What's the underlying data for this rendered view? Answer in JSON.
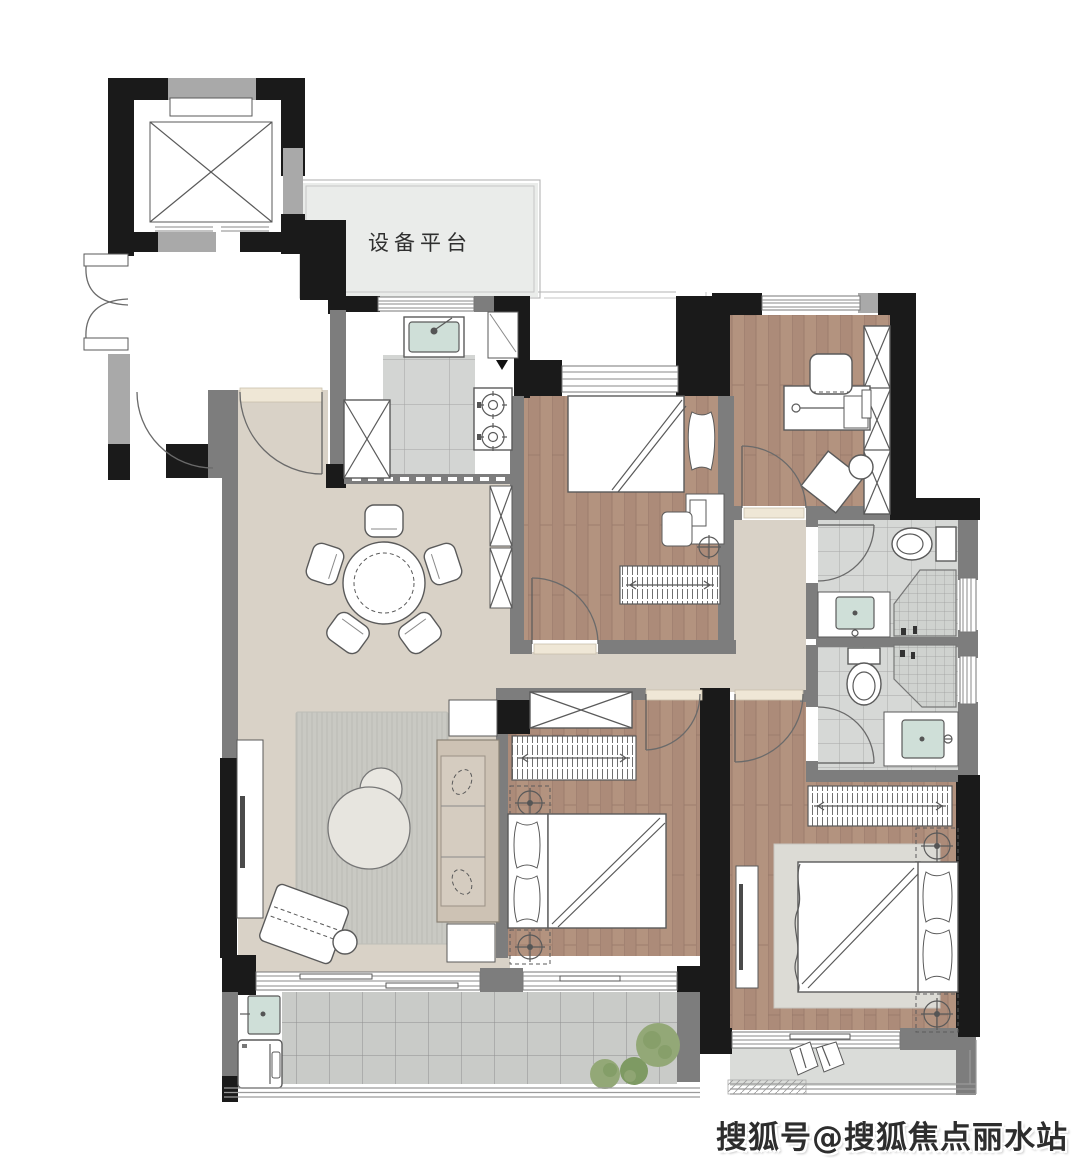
{
  "labels": {
    "equipment_platform": "设备平台",
    "watermark": "搜狐号@搜狐焦点丽水站"
  },
  "colors": {
    "wall_black": "#1a1a1a",
    "wall_gray": "#7d7d7d",
    "wall_light": "#a9a9a9",
    "floor_public": "#d9d2c7",
    "platform": "#eaecea",
    "wood_base": "#ac8b79",
    "wood_light": "#b79883",
    "wood_line": "#97786a",
    "tile_bath": "#d6d8d6",
    "tile_bath_line": "#a6a6a6",
    "tile_balcony": "#c9cbc8",
    "tile_balcony_line": "#8f8f8f",
    "tile_kitchen": "#d3d5d3",
    "tile_fine": "#cfd2cf",
    "stroke": "#5a5a5a",
    "basin": "#cfdfd8",
    "plant_dark": "#7e9a63",
    "plant_light": "#93a877",
    "sofa": "#cdc2b4",
    "sofa_seat": "#d5ccc0",
    "rug_base": "#c9c9c3",
    "rug_line": "#bbbbb5",
    "threshold": "#efe7d6",
    "mbalcony_floor": "#dadcd9",
    "watermark": "#2d2d2d",
    "label": "#2f2f2f"
  },
  "elements": {
    "rooms": [
      "elevator",
      "lobby",
      "equipment-platform",
      "kitchen",
      "dining-area",
      "living-room",
      "bedroom-top",
      "study",
      "bathroom-upper",
      "bathroom-lower",
      "bedroom-middle",
      "master-bedroom",
      "balcony",
      "master-balcony"
    ],
    "furniture_icons": [
      "elevator-x-icon",
      "round-dining-table-icon",
      "dining-chair-icon",
      "sofa-icon",
      "coffee-table-icon",
      "armchair-icon",
      "tv-cabinet-icon",
      "rug-icon",
      "single-bed-icon",
      "double-bed-icon",
      "pillow-icon",
      "nightstand-lamp-icon",
      "striped-dresser-icon",
      "wardrobe-x-icon",
      "desk-icon",
      "desk-chair-icon",
      "kitchen-sink-icon",
      "stove-icon",
      "fridge-x-icon",
      "toilet-icon",
      "vanity-basin-icon",
      "shower-icon",
      "washing-machine-icon",
      "laundry-sink-icon",
      "plant-icon",
      "door-swing-icon",
      "window-icon",
      "lounge-pillow-icon"
    ]
  }
}
